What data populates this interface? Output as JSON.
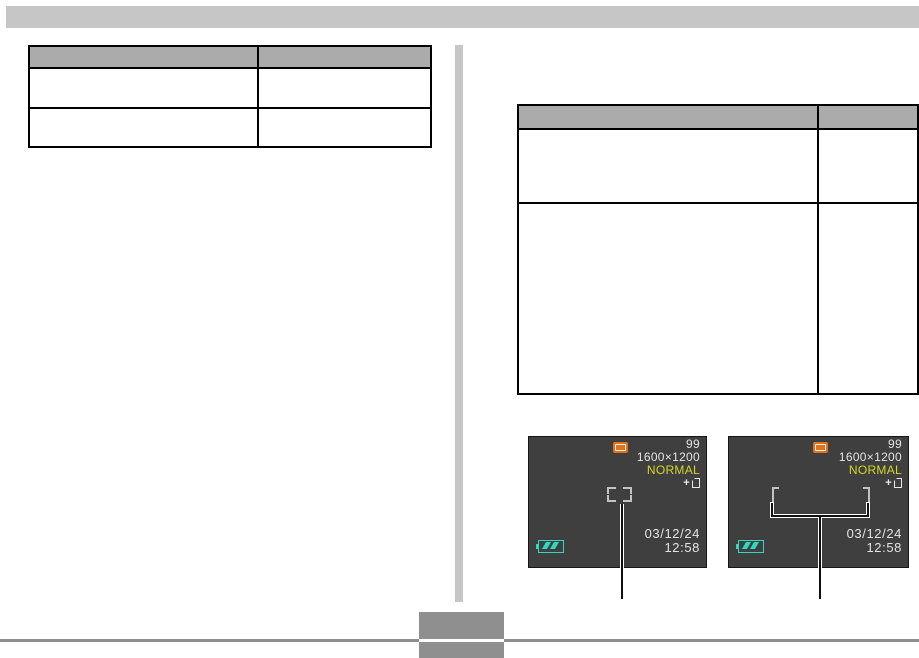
{
  "page_type": "camera-manual-page",
  "header": {
    "bar": ""
  },
  "left_table": {
    "headers": [
      "",
      ""
    ],
    "rows": [
      [
        "",
        ""
      ],
      [
        "",
        ""
      ]
    ],
    "header_fill": "#ababab"
  },
  "right_table": {
    "headers": [
      "",
      ""
    ],
    "rows": [
      [
        "",
        ""
      ],
      [
        "",
        ""
      ]
    ],
    "header_fill": "#ababab"
  },
  "screens": [
    {
      "remaining_shots": "99",
      "image_size": "1600×1200",
      "quality": "NORMAL",
      "date": "03/12/24",
      "time": "12:58",
      "focus_frame_type": "spot",
      "mode_icon": "snapshot-mode-icon",
      "save_icon": "memory-save-icon",
      "battery_icon": "battery-level-icon"
    },
    {
      "remaining_shots": "99",
      "image_size": "1600×1200",
      "quality": "NORMAL",
      "date": "03/12/24",
      "time": "12:58",
      "focus_frame_type": "wide",
      "mode_icon": "snapshot-mode-icon",
      "save_icon": "memory-save-icon",
      "battery_icon": "battery-level-icon"
    }
  ],
  "colors": {
    "screen_bg": "#3f3f3f",
    "screen_text": "#e3e3e3",
    "quality_yellow": "#d2d726",
    "battery_teal": "#2fd9be",
    "mode_orange": "#e0721c",
    "focus_bracket": "#c2c2c2",
    "table_header_fill": "#ababab",
    "page_gray": "#c6c6c6",
    "footer_gray": "#8f8f8f"
  },
  "footer": {
    "page_number": ""
  }
}
